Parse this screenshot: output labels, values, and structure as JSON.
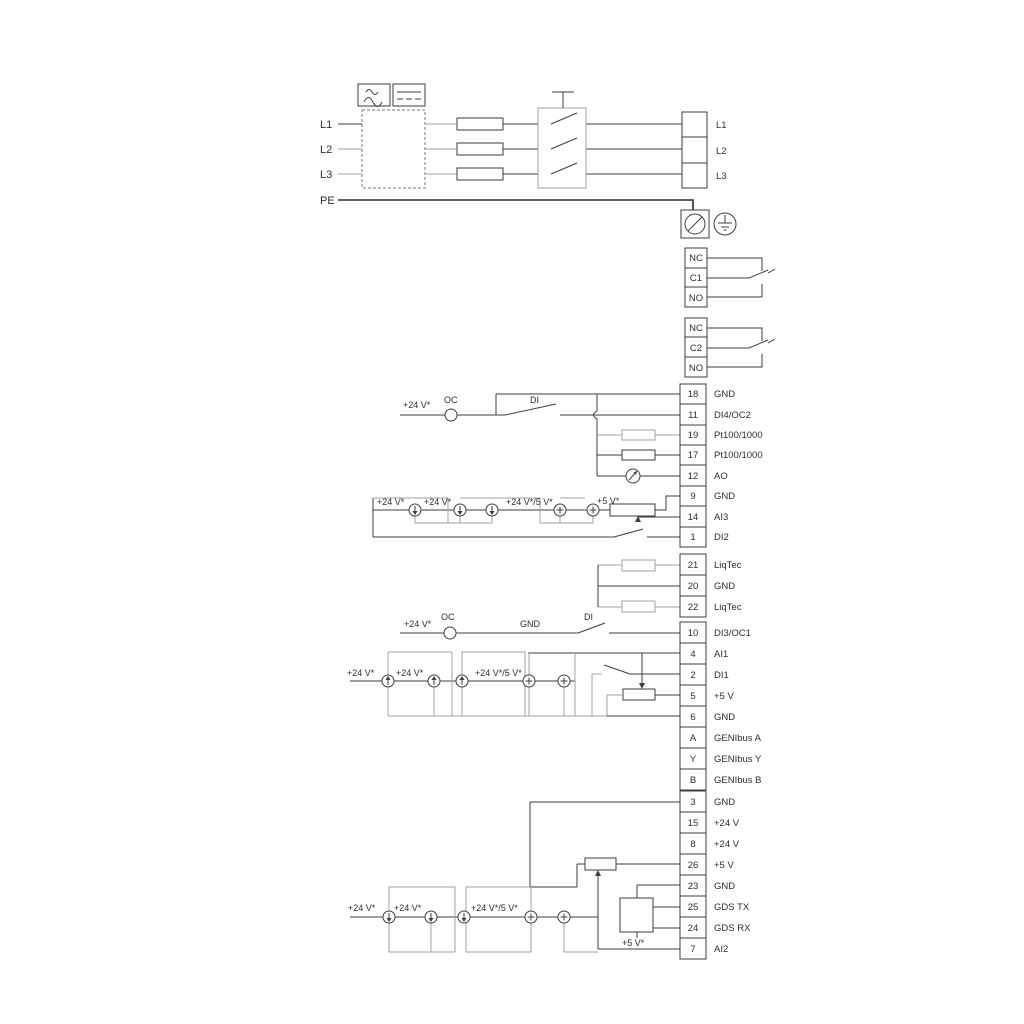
{
  "colors": {
    "line": "#3d3d3d",
    "line_gray": "#a0a0a0",
    "text": "#2e2e2e",
    "background": "#ffffff"
  },
  "power_in": {
    "l1": "L1",
    "l2": "L2",
    "l3": "L3",
    "pe": "PE"
  },
  "power_out": {
    "l1": "L1",
    "l2": "L2",
    "l3": "L3"
  },
  "relay1": {
    "nc": "NC",
    "com": "C1",
    "no": "NO"
  },
  "relay2": {
    "nc": "NC",
    "com": "C2",
    "no": "NO"
  },
  "io1": [
    {
      "no": "18",
      "label": "GND"
    },
    {
      "no": "11",
      "label": "DI4/OC2"
    },
    {
      "no": "19",
      "label": "Pt100/1000"
    },
    {
      "no": "17",
      "label": "Pt100/1000"
    },
    {
      "no": "12",
      "label": "AO"
    },
    {
      "no": "9",
      "label": "GND"
    },
    {
      "no": "14",
      "label": "AI3"
    },
    {
      "no": "1",
      "label": "DI2"
    }
  ],
  "liqtec": [
    {
      "no": "21",
      "label": "LiqTec"
    },
    {
      "no": "20",
      "label": "GND"
    },
    {
      "no": "22",
      "label": "LiqTec"
    }
  ],
  "io2": [
    {
      "no": "10",
      "label": "DI3/OC1"
    },
    {
      "no": "4",
      "label": "AI1"
    },
    {
      "no": "2",
      "label": "DI1"
    },
    {
      "no": "5",
      "label": "+5 V"
    },
    {
      "no": "6",
      "label": "GND"
    },
    {
      "no": "A",
      "label": "GENIbus A"
    },
    {
      "no": "Y",
      "label": "GENIbus Y"
    },
    {
      "no": "B",
      "label": "GENIbus B"
    }
  ],
  "io3": [
    {
      "no": "3",
      "label": "GND"
    },
    {
      "no": "15",
      "label": "+24 V"
    },
    {
      "no": "8",
      "label": "+24 V"
    },
    {
      "no": "26",
      "label": "+5 V"
    },
    {
      "no": "23",
      "label": "GND"
    },
    {
      "no": "25",
      "label": "GDS TX"
    },
    {
      "no": "24",
      "label": "GDS RX"
    },
    {
      "no": "7",
      "label": "AI2"
    }
  ],
  "ann": {
    "di4": {
      "v24": "+24 V*",
      "oc": "OC",
      "di": "DI"
    },
    "ai3": {
      "v24a": "+24 V*",
      "v24b": "+24 V*",
      "v245": "+24 V*/5 V*",
      "v5": "+5 V*"
    },
    "di3": {
      "v24": "+24 V*",
      "oc": "OC",
      "gnd": "GND",
      "di": "DI"
    },
    "ai1": {
      "v24a": "+24 V*",
      "v24b": "+24 V*",
      "v245": "+24 V*/5 V*"
    },
    "ai2": {
      "v24a": "+24 V*",
      "v24b": "+24 V*",
      "v245": "+24 V*/5 V*",
      "v5": "+5 V*"
    }
  }
}
